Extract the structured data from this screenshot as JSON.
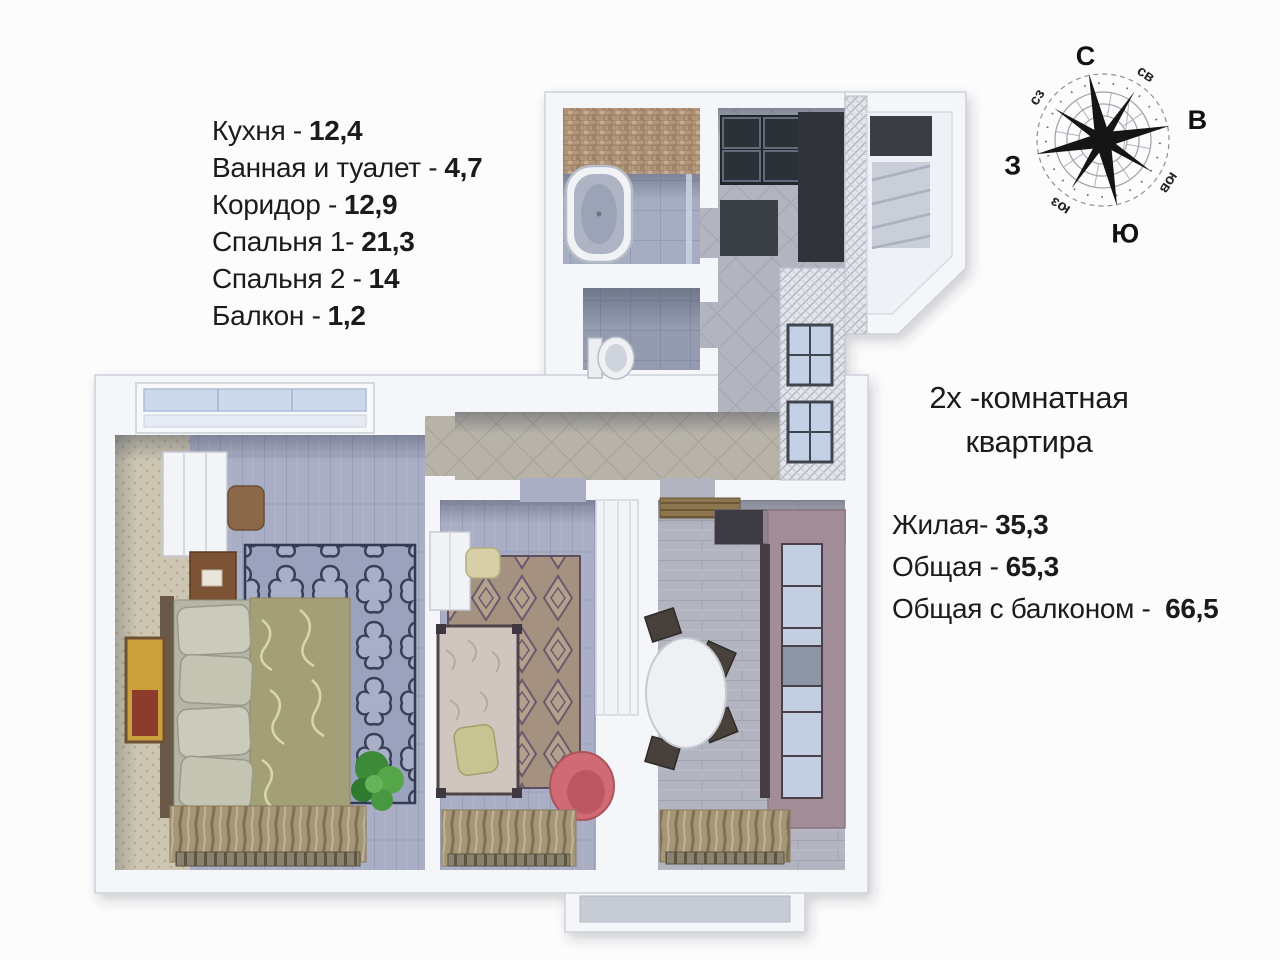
{
  "room_list": {
    "items": [
      {
        "label": "Кухня -",
        "value": "12,4"
      },
      {
        "label": "Ванная и туалет -",
        "value": "4,7"
      },
      {
        "label": "Коридор -",
        "value": "12,9"
      },
      {
        "label": "Спальня 1-",
        "value": "21,3"
      },
      {
        "label": "Спальня 2 -",
        "value": "14"
      },
      {
        "label": "Балкон -",
        "value": "1,2"
      }
    ]
  },
  "summary": {
    "title_line1": "2х -комнатная",
    "title_line2": "квартира",
    "items": [
      {
        "label": "Жилая-",
        "value": "35,3"
      },
      {
        "label": "Общая -",
        "value": "65,3"
      },
      {
        "label": "Общая с балконом - ",
        "value": "66,5"
      }
    ]
  },
  "compass": {
    "n": "С",
    "ne": "св",
    "e": "В",
    "se": "юв",
    "s": "Ю",
    "sw": "юз",
    "w": "З",
    "nw": "сз"
  },
  "colors": {
    "text": "#1b1b1b",
    "wall": "#f4f6f9",
    "corridor_tile": "#b7b3a9",
    "bedroom_floor": "#a9aec5",
    "kitchen_cabinet": "#a28c97",
    "armchair": "#d06b74",
    "plant": "#3e8a37",
    "bed_cover": "#a3a077"
  }
}
